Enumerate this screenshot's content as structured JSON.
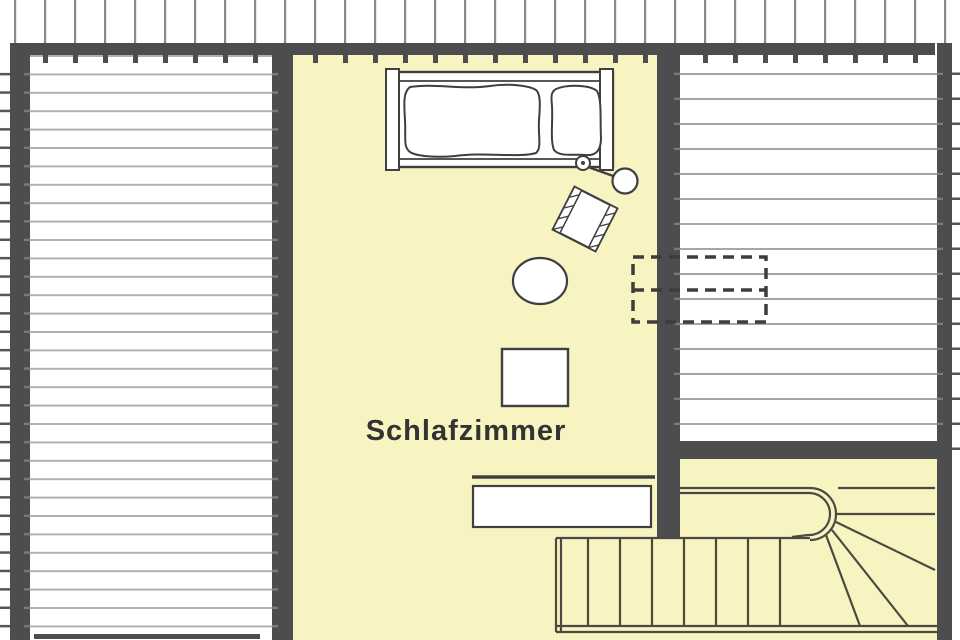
{
  "room": {
    "label": "Schlafzimmer"
  },
  "colors": {
    "wall": "#4d4d4f",
    "floor": "#f8f4c1",
    "attic_background": "#ffffff",
    "stripe": "#b0b0b0",
    "rafter": "#8a8a8a",
    "outline": "#3f3f3f",
    "stair_line": "#4a4a42",
    "dashed": "#3d3d3d",
    "label_text": "#333333"
  },
  "furniture_icons": [
    "double-bed-icon",
    "duvet-icon",
    "pillow-icon",
    "bed-knob-icon",
    "reading-lamp-icon",
    "armchair-icon",
    "oval-rug-icon",
    "square-table-icon",
    "sideboard-icon",
    "winder-stairs-icon",
    "skylight-dashed-icon"
  ]
}
